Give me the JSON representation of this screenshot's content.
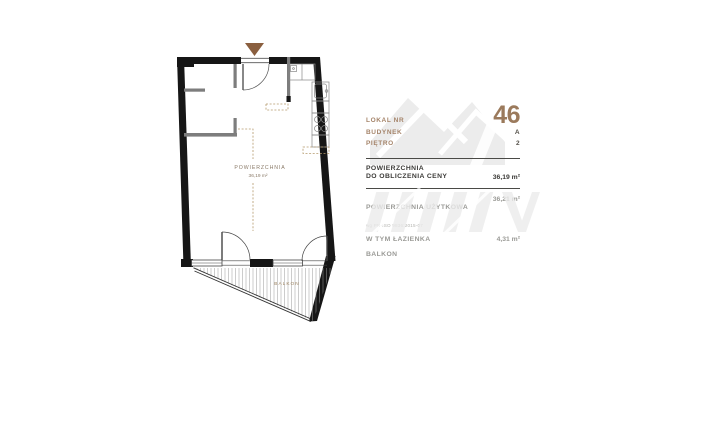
{
  "plan": {
    "area_label": "POWIERZCHNIA",
    "area_value": "36,19 m²",
    "balcony_label": "BALKON"
  },
  "panel": {
    "unit": {
      "label": "LOKAL NR",
      "value": "46"
    },
    "building": {
      "label": "BUDYNEK",
      "value": "A"
    },
    "floor": {
      "label": "PIĘTRO",
      "value": "2"
    },
    "price_area": {
      "label_line1": "POWIERZCHNIA",
      "label_line2": "DO OBLICZENIA CENY",
      "value": "36,19 m²"
    },
    "usable_area": {
      "label": "POWIERZCHNIA UŻYTKOWA",
      "sublabel": "wg PN-ISO 9836:2015-07",
      "value": "36,21 m²"
    },
    "bathroom": {
      "label": "W TYM ŁAZIENKA",
      "value": "4,31 m²"
    },
    "balcony": {
      "label": "BALKON",
      "value": ""
    }
  },
  "colors": {
    "accent_brown": "#9b7a5c",
    "label_brown": "#a5846a",
    "dashed_brown": "#b59a6d",
    "wall_black": "#161616",
    "interior_gray": "#7d7d7d",
    "text_dark": "#3c3b38",
    "text_gray": "#9a9a96",
    "watermark_gray": "#ececec"
  }
}
